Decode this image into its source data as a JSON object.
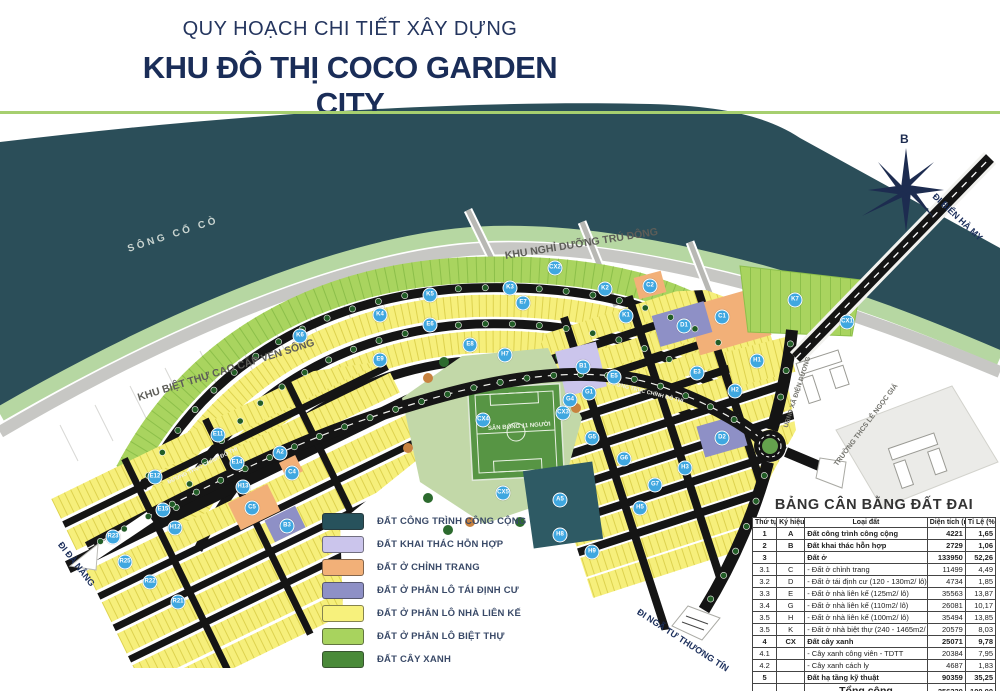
{
  "header": {
    "subtitle": "QUY HOẠCH CHI TIẾT XÂY DỰNG",
    "title": "KHU ĐÔ THỊ COCO GARDEN CITY"
  },
  "map": {
    "compass_label": "B",
    "accent_colors": {
      "river": "#2b4e59",
      "river_bank": "#b6d7a2",
      "road_dark": "#151515",
      "marker_blue": "#3fa7e0",
      "title_navy": "#1a2d58",
      "divider_green": "#a6cf6f"
    },
    "labels": [
      {
        "text": "SÔNG CỔ CÒ",
        "x": 128,
        "y": 244,
        "rot": "rotate(-18deg)",
        "fs": "10px",
        "col": "#c9d4d0",
        "ls": "3px"
      },
      {
        "text": "KHU NGHỈ DƯỠNG TRÚ ĐÔNG",
        "x": 505,
        "y": 250,
        "rot": "rotate(-9deg)",
        "fs": "10.5px",
        "col": "#5d5d58"
      },
      {
        "text": "KHU BIỆT THỰ CAO CẤP VEN SÔNG",
        "x": 138,
        "y": 392,
        "rot": "rotate(-17.5deg)",
        "fs": "10.5px",
        "col": "#5d5d58"
      },
      {
        "text": "ĐI ĐÀ NẴNG",
        "x": 60,
        "y": 538,
        "rot": "rotate(52deg)",
        "fs": "9px",
        "col": "#1c2f5c"
      },
      {
        "text": "ĐI NGÃ TƯ THƯƠNG TÍN",
        "x": 638,
        "y": 606,
        "rot": "rotate(33deg)",
        "fs": "9px",
        "col": "#1c2f5c"
      },
      {
        "text": "ĐI BIỂN HÀ MY",
        "x": 934,
        "y": 190,
        "rot": "rotate(43deg)",
        "fs": "9px",
        "col": "#1c2f5c"
      },
      {
        "text": "UBND XÃ ĐIỆN DƯƠNG",
        "x": 786,
        "y": 424,
        "rot": "rotate(-72deg)",
        "fs": "6.5px",
        "col": "#73736d"
      },
      {
        "text": "TRƯỜNG THCS LÊ NGỌC GIÁ",
        "x": 836,
        "y": 462,
        "rot": "rotate(-53deg)",
        "fs": "7px",
        "col": "#73736d"
      },
      {
        "text": "ĐƯỜNG TRỤC CHÍNH ĐÔ THỊ",
        "x": 168,
        "y": 480,
        "rot": "rotate(-26deg)",
        "fs": "5.5px",
        "col": "#efefe8"
      },
      {
        "text": "ĐƯỜNG TRỤC CHÍNH ĐÔ THỊ",
        "x": 608,
        "y": 380,
        "rot": "rotate(14deg)",
        "fs": "5.5px",
        "col": "#efefe8"
      },
      {
        "text": "SÂN BÓNG 11 NGƯỜI",
        "x": 488,
        "y": 426,
        "rot": "rotate(-4deg)",
        "fs": "6px",
        "col": "#eef4e6"
      }
    ],
    "blocks": [
      {
        "t": "K6",
        "x": 300,
        "y": 336
      },
      {
        "t": "K4",
        "x": 380,
        "y": 315
      },
      {
        "t": "K5",
        "x": 430,
        "y": 295
      },
      {
        "t": "K3",
        "x": 510,
        "y": 288
      },
      {
        "t": "CX2",
        "x": 555,
        "y": 268
      },
      {
        "t": "K2",
        "x": 605,
        "y": 289
      },
      {
        "t": "K1",
        "x": 626,
        "y": 316
      },
      {
        "t": "C2",
        "x": 650,
        "y": 286
      },
      {
        "t": "C1",
        "x": 722,
        "y": 317
      },
      {
        "t": "D1",
        "x": 684,
        "y": 326
      },
      {
        "t": "B1",
        "x": 583,
        "y": 367
      },
      {
        "t": "E7",
        "x": 523,
        "y": 303
      },
      {
        "t": "E6",
        "x": 430,
        "y": 325
      },
      {
        "t": "E8",
        "x": 470,
        "y": 345
      },
      {
        "t": "H7",
        "x": 505,
        "y": 355
      },
      {
        "t": "E9",
        "x": 380,
        "y": 360
      },
      {
        "t": "E3",
        "x": 697,
        "y": 373
      },
      {
        "t": "E5",
        "x": 614,
        "y": 377
      },
      {
        "t": "G1",
        "x": 589,
        "y": 393
      },
      {
        "t": "G4",
        "x": 570,
        "y": 400
      },
      {
        "t": "G5",
        "x": 592,
        "y": 438
      },
      {
        "t": "G6",
        "x": 624,
        "y": 459
      },
      {
        "t": "D2",
        "x": 722,
        "y": 438
      },
      {
        "t": "H1",
        "x": 757,
        "y": 361
      },
      {
        "t": "H2",
        "x": 735,
        "y": 391
      },
      {
        "t": "CX1",
        "x": 847,
        "y": 322
      },
      {
        "t": "K7",
        "x": 795,
        "y": 300
      },
      {
        "t": "CX4",
        "x": 483,
        "y": 420
      },
      {
        "t": "CX3",
        "x": 563,
        "y": 413
      },
      {
        "t": "CX5",
        "x": 503,
        "y": 493
      },
      {
        "t": "A5",
        "x": 560,
        "y": 500
      },
      {
        "t": "G7",
        "x": 655,
        "y": 485
      },
      {
        "t": "H3",
        "x": 685,
        "y": 468
      },
      {
        "t": "H5",
        "x": 640,
        "y": 508
      },
      {
        "t": "H8",
        "x": 560,
        "y": 535
      },
      {
        "t": "H9",
        "x": 592,
        "y": 552
      },
      {
        "t": "E11",
        "x": 218,
        "y": 435
      },
      {
        "t": "E14",
        "x": 237,
        "y": 463
      },
      {
        "t": "E12",
        "x": 155,
        "y": 477
      },
      {
        "t": "E15",
        "x": 163,
        "y": 510
      },
      {
        "t": "H13",
        "x": 243,
        "y": 487
      },
      {
        "t": "H12",
        "x": 175,
        "y": 528
      },
      {
        "t": "A2",
        "x": 280,
        "y": 453
      },
      {
        "t": "C4",
        "x": 292,
        "y": 473
      },
      {
        "t": "C5",
        "x": 252,
        "y": 508
      },
      {
        "t": "B3",
        "x": 287,
        "y": 526
      },
      {
        "t": "R23",
        "x": 113,
        "y": 537
      },
      {
        "t": "R25",
        "x": 125,
        "y": 562
      },
      {
        "t": "R22",
        "x": 150,
        "y": 582
      },
      {
        "t": "R21",
        "x": 178,
        "y": 602
      }
    ]
  },
  "legend": {
    "items": [
      {
        "label": "ĐẤT CÔNG TRÌNH CÔNG CỘNG",
        "color": "#27525c"
      },
      {
        "label": "ĐẤT KHAI THÁC HỖN HỢP",
        "color": "#cbc5ec"
      },
      {
        "label": "ĐẤT Ở CHỈNH TRANG",
        "color": "#f2b078"
      },
      {
        "label": "ĐẤT Ở PHÂN LÔ TÁI ĐỊNH CƯ",
        "color": "#8e90c6"
      },
      {
        "label": "ĐẤT Ở PHÂN LÔ NHÀ LIÊN KẾ",
        "color": "#f7f17c"
      },
      {
        "label": "ĐẤT Ở PHÂN LÔ BIỆT THỰ",
        "color": "#a8d35e"
      },
      {
        "label": "ĐẤT CÂY XANH",
        "color": "#4a8a39"
      }
    ]
  },
  "table": {
    "title": "BẢNG CÂN BẰNG ĐẤT ĐAI",
    "headers": [
      "Thứ tự",
      "Ký hiệu",
      "Loại đất",
      "Diện tích (m2)",
      "Tỉ Lệ (%)"
    ],
    "rows": [
      {
        "n": "1",
        "k": "A",
        "t": "Đất công trình công cộng",
        "a": "4221",
        "p": "1,65",
        "fw": "bold",
        "tfs": "7.5px",
        "ta": "left"
      },
      {
        "n": "2",
        "k": "B",
        "t": "Đất khai thác hỗn hợp",
        "a": "2729",
        "p": "1,06",
        "fw": "bold",
        "tfs": "7.5px",
        "ta": "left"
      },
      {
        "n": "3",
        "k": "",
        "t": "Đất ở",
        "a": "133950",
        "p": "52,26",
        "fw": "bold",
        "tfs": "7.5px",
        "ta": "left"
      },
      {
        "n": "3.1",
        "k": "C",
        "t": "- Đất ở chỉnh trang",
        "a": "11499",
        "p": "4,49",
        "fw": "normal",
        "tfs": "7.5px",
        "ta": "left"
      },
      {
        "n": "3.2",
        "k": "D",
        "t": "- Đất ở tái định cư (120 - 130m2/ lô)",
        "a": "4734",
        "p": "1,85",
        "fw": "normal",
        "tfs": "7.5px",
        "ta": "left"
      },
      {
        "n": "3.3",
        "k": "E",
        "t": "- Đất ở nhà liên kế (125m2/ lô)",
        "a": "35563",
        "p": "13,87",
        "fw": "normal",
        "tfs": "7.5px",
        "ta": "left"
      },
      {
        "n": "3.4",
        "k": "G",
        "t": "- Đất ở nhà liên kế (110m2/ lô)",
        "a": "26081",
        "p": "10,17",
        "fw": "normal",
        "tfs": "7.5px",
        "ta": "left"
      },
      {
        "n": "3.5",
        "k": "H",
        "t": "- Đất ở nhà liên kế (100m2/ lô)",
        "a": "35494",
        "p": "13,85",
        "fw": "normal",
        "tfs": "7.5px",
        "ta": "left"
      },
      {
        "n": "3.5",
        "k": "K",
        "t": "- Đất ở nhà biệt thự (240 - 1465m2/ lô)",
        "a": "20579",
        "p": "8,03",
        "fw": "normal",
        "tfs": "7.5px",
        "ta": "left"
      },
      {
        "n": "4",
        "k": "CX",
        "t": "Đất cây xanh",
        "a": "25071",
        "p": "9,78",
        "fw": "bold",
        "tfs": "7.5px",
        "ta": "left"
      },
      {
        "n": "4.1",
        "k": "",
        "t": "- Cây xanh công viên - TDTT",
        "a": "20384",
        "p": "7,95",
        "fw": "normal",
        "tfs": "7.5px",
        "ta": "left"
      },
      {
        "n": "4.2",
        "k": "",
        "t": "- Cây xanh cách ly",
        "a": "4687",
        "p": "1,83",
        "fw": "normal",
        "tfs": "7.5px",
        "ta": "left"
      },
      {
        "n": "5",
        "k": "",
        "t": "Đất hạ tầng kỹ thuật",
        "a": "90359",
        "p": "35,25",
        "fw": "bold",
        "tfs": "7.5px",
        "ta": "left"
      },
      {
        "n": "",
        "k": "",
        "t": "Tổng cộng",
        "a": "256330",
        "p": "100,00",
        "fw": "bold",
        "tfs": "10.5px",
        "ta": "center"
      }
    ]
  }
}
